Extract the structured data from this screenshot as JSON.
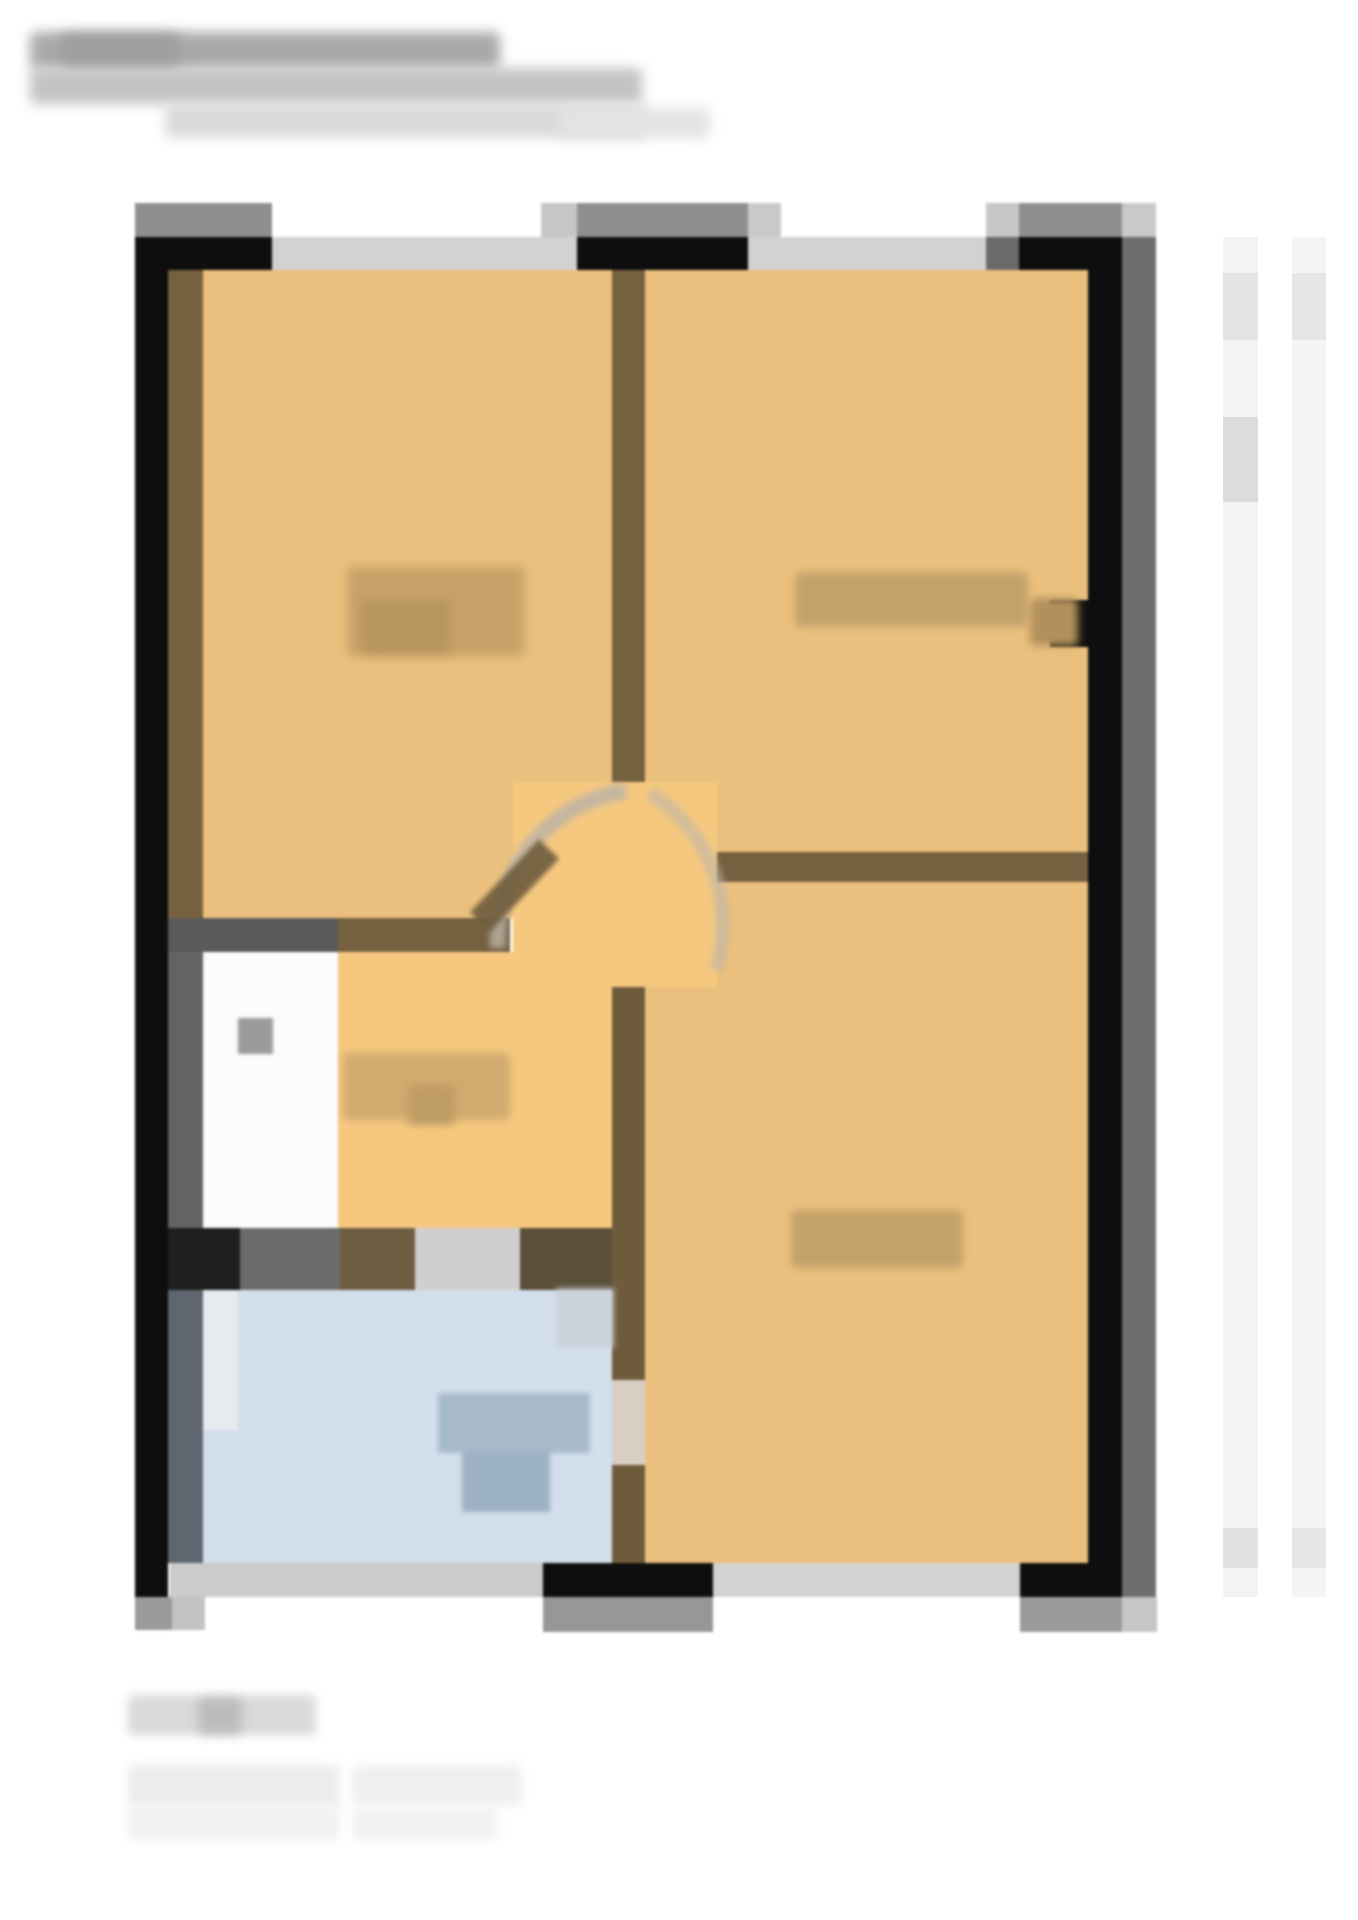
{
  "meta": {
    "canvas_w": 1358,
    "canvas_h": 1920,
    "background": "#ffffff",
    "description": "Heavily blurred / pixelated real-estate floor-plan screenshot; all text illegible"
  },
  "palette": {
    "wall_black": "#0e0e0e",
    "wall_brown": "#75613f",
    "wall_gray": "#5a5a5a",
    "window_gray": "#d2d2d2",
    "cap_gray": "#8f8f8f",
    "room_orange": "#ebc07e",
    "hall_orange": "#f6c87f",
    "wc_white": "#fbfbfb",
    "bath_blue": "#d3dfec",
    "label_tan": "#c3a16a",
    "right_wall_shadow": "#6e6e6e"
  },
  "title_block": [
    {
      "name": "title-blur-line-1",
      "x": 30,
      "y": 32,
      "w": 470,
      "h": 37,
      "color": "#a9a9a9",
      "blur": 6
    },
    {
      "name": "title-blur-line-1-dark",
      "x": 60,
      "y": 34,
      "w": 120,
      "h": 34,
      "color": "#9f9f9f",
      "blur": 6
    },
    {
      "name": "title-blur-line-2",
      "x": 30,
      "y": 68,
      "w": 612,
      "h": 36,
      "color": "#c3c3c3",
      "blur": 6
    },
    {
      "name": "title-blur-line-3",
      "x": 165,
      "y": 104,
      "w": 480,
      "h": 34,
      "color": "#dadada",
      "blur": 6
    },
    {
      "name": "title-blur-line-3-tail",
      "x": 560,
      "y": 108,
      "w": 150,
      "h": 30,
      "color": "#e3e3e3",
      "blur": 6
    }
  ],
  "floor_plan": {
    "blocks": [
      {
        "name": "room-top-left",
        "x": 203,
        "y": 270,
        "w": 409,
        "h": 648,
        "color": "#ebc07e"
      },
      {
        "name": "room-top-right",
        "x": 645,
        "y": 270,
        "w": 443,
        "h": 582,
        "color": "#ebc07e"
      },
      {
        "name": "room-bottom-right",
        "x": 645,
        "y": 882,
        "w": 443,
        "h": 681,
        "color": "#ebc07e"
      },
      {
        "name": "hallway-floor",
        "x": 513,
        "y": 782,
        "w": 204,
        "h": 205,
        "color": "#f6c87f"
      },
      {
        "name": "kitchen-floor",
        "x": 338,
        "y": 952,
        "w": 274,
        "h": 338,
        "color": "#f6c87f"
      },
      {
        "name": "wc-room-floor",
        "x": 203,
        "y": 952,
        "w": 135,
        "h": 276,
        "color": "#fbfbfb"
      },
      {
        "name": "bathroom-floor",
        "x": 203,
        "y": 1290,
        "w": 409,
        "h": 273,
        "color": "#d3dfec"
      },
      {
        "name": "wall-lining-left-top",
        "x": 168,
        "y": 270,
        "w": 35,
        "h": 648,
        "color": "#75613f"
      },
      {
        "name": "wall-mid-vertical-top",
        "x": 612,
        "y": 270,
        "w": 33,
        "h": 512,
        "color": "#75613f"
      },
      {
        "name": "wall-mid-vertical-bottom",
        "x": 612,
        "y": 987,
        "w": 33,
        "h": 576,
        "color": "#6e5b3c"
      },
      {
        "name": "wall-horizontal-right",
        "x": 717,
        "y": 852,
        "w": 371,
        "h": 30,
        "color": "#75613f"
      },
      {
        "name": "wall-horizontal-left-brown",
        "x": 338,
        "y": 918,
        "w": 172,
        "h": 34,
        "color": "#75613f"
      },
      {
        "name": "wall-horizontal-left-gray",
        "x": 168,
        "y": 918,
        "w": 170,
        "h": 34,
        "color": "#5a5a5a"
      },
      {
        "name": "wall-lining-wc-left",
        "x": 168,
        "y": 952,
        "w": 35,
        "h": 276,
        "color": "#636363"
      },
      {
        "name": "wall-band-kitchen-1",
        "x": 168,
        "y": 1228,
        "w": 72,
        "h": 62,
        "color": "#1f1f1f"
      },
      {
        "name": "wall-band-kitchen-2",
        "x": 240,
        "y": 1228,
        "w": 100,
        "h": 62,
        "color": "#6b6b6b"
      },
      {
        "name": "wall-band-kitchen-3",
        "x": 340,
        "y": 1228,
        "w": 75,
        "h": 62,
        "color": "#6e5c42"
      },
      {
        "name": "wall-band-kitchen-door",
        "x": 415,
        "y": 1228,
        "w": 105,
        "h": 62,
        "color": "#cfcfcf"
      },
      {
        "name": "wall-band-kitchen-5",
        "x": 520,
        "y": 1228,
        "w": 92,
        "h": 62,
        "color": "#5b4f3a"
      },
      {
        "name": "wall-lining-left-bottom",
        "x": 168,
        "y": 1290,
        "w": 35,
        "h": 273,
        "color": "#5f6670"
      },
      {
        "name": "bathroom-door-left",
        "x": 203,
        "y": 1290,
        "w": 35,
        "h": 140,
        "color": "#e7eaee"
      },
      {
        "name": "bathroom-door-gap-right",
        "x": 612,
        "y": 1380,
        "w": 33,
        "h": 85,
        "color": "#d8cfc2"
      },
      {
        "name": "wall-outer-left",
        "x": 135,
        "y": 237,
        "w": 33,
        "h": 1360,
        "color": "#0e0e0e"
      },
      {
        "name": "wall-outer-top-segment-1",
        "x": 135,
        "y": 237,
        "w": 137,
        "h": 33,
        "color": "#0e0e0e"
      },
      {
        "name": "window-top-1",
        "x": 272,
        "y": 237,
        "w": 305,
        "h": 33,
        "color": "#d2d2d2"
      },
      {
        "name": "wall-outer-top-segment-2",
        "x": 577,
        "y": 237,
        "w": 171,
        "h": 33,
        "color": "#0e0e0e"
      },
      {
        "name": "window-top-2",
        "x": 748,
        "y": 237,
        "w": 238,
        "h": 33,
        "color": "#d2d2d2"
      },
      {
        "name": "window-top-2-end",
        "x": 986,
        "y": 237,
        "w": 33,
        "h": 33,
        "color": "#6a6a6a"
      },
      {
        "name": "wall-outer-top-segment-3",
        "x": 1019,
        "y": 237,
        "w": 103,
        "h": 33,
        "color": "#0e0e0e"
      },
      {
        "name": "wall-outer-right",
        "x": 1088,
        "y": 237,
        "w": 34,
        "h": 1360,
        "color": "#0e0e0e"
      },
      {
        "name": "wall-outer-right-shadow",
        "x": 1122,
        "y": 237,
        "w": 34,
        "h": 1360,
        "color": "#6e6e6e"
      },
      {
        "name": "wall-right-notch",
        "x": 1050,
        "y": 600,
        "w": 38,
        "h": 47,
        "color": "#101010"
      },
      {
        "name": "window-bottom-1",
        "x": 170,
        "y": 1563,
        "w": 373,
        "h": 34,
        "color": "#cbcbcb"
      },
      {
        "name": "wall-outer-bottom-segment-1",
        "x": 543,
        "y": 1563,
        "w": 170,
        "h": 34,
        "color": "#0e0e0e"
      },
      {
        "name": "window-bottom-2",
        "x": 713,
        "y": 1563,
        "w": 307,
        "h": 34,
        "color": "#d2d2d2"
      },
      {
        "name": "wall-outer-bottom-segment-2",
        "x": 1020,
        "y": 1563,
        "w": 68,
        "h": 34,
        "color": "#0e0e0e"
      },
      {
        "name": "cap-top-1",
        "x": 135,
        "y": 203,
        "w": 137,
        "h": 34,
        "color": "#8f8f8f"
      },
      {
        "name": "cap-top-2a",
        "x": 541,
        "y": 203,
        "w": 36,
        "h": 34,
        "color": "#c6c6c6"
      },
      {
        "name": "cap-top-2",
        "x": 577,
        "y": 203,
        "w": 171,
        "h": 34,
        "color": "#8f8f8f"
      },
      {
        "name": "cap-top-2b",
        "x": 748,
        "y": 203,
        "w": 33,
        "h": 34,
        "color": "#c9c9c9"
      },
      {
        "name": "cap-top-3a",
        "x": 986,
        "y": 203,
        "w": 33,
        "h": 34,
        "color": "#c6c6c6"
      },
      {
        "name": "cap-top-3",
        "x": 1019,
        "y": 203,
        "w": 103,
        "h": 34,
        "color": "#8f8f8f"
      },
      {
        "name": "cap-top-3b",
        "x": 1122,
        "y": 203,
        "w": 34,
        "h": 34,
        "color": "#c9c9c9"
      },
      {
        "name": "cap-bottom-left-a",
        "x": 135,
        "y": 1597,
        "w": 37,
        "h": 33,
        "color": "#9a9a9a"
      },
      {
        "name": "cap-bottom-left-b",
        "x": 172,
        "y": 1597,
        "w": 33,
        "h": 33,
        "color": "#c2c2c2"
      },
      {
        "name": "cap-bottom-mid",
        "x": 543,
        "y": 1597,
        "w": 170,
        "h": 35,
        "color": "#979797"
      },
      {
        "name": "cap-bottom-right",
        "x": 1020,
        "y": 1597,
        "w": 102,
        "h": 35,
        "color": "#9a9a9a"
      },
      {
        "name": "cap-bottom-right-b",
        "x": 1122,
        "y": 1597,
        "w": 35,
        "h": 35,
        "color": "#c6c6c6"
      },
      {
        "name": "label-room-top-left",
        "x": 347,
        "y": 567,
        "w": 178,
        "h": 89,
        "color": "#c6a168",
        "blur": 5
      },
      {
        "name": "label-room-top-left-dark",
        "x": 362,
        "y": 600,
        "w": 88,
        "h": 54,
        "color": "#b8955f",
        "blur": 5
      },
      {
        "name": "label-room-top-right",
        "x": 795,
        "y": 572,
        "w": 233,
        "h": 55,
        "color": "#c3a16a",
        "blur": 4
      },
      {
        "name": "label-room-top-right-dark",
        "x": 1030,
        "y": 598,
        "w": 48,
        "h": 48,
        "color": "#b2905b",
        "blur": 4
      },
      {
        "name": "label-room-bottom-right",
        "x": 791,
        "y": 1210,
        "w": 172,
        "h": 58,
        "color": "#c3a16a",
        "blur": 4
      },
      {
        "name": "label-kitchen",
        "x": 343,
        "y": 1053,
        "w": 167,
        "h": 67,
        "color": "#d0aa6f",
        "blur": 4
      },
      {
        "name": "label-kitchen-dark",
        "x": 408,
        "y": 1085,
        "w": 47,
        "h": 40,
        "color": "#bf9c64",
        "blur": 4
      },
      {
        "name": "fixture-bath-upper",
        "x": 438,
        "y": 1393,
        "w": 152,
        "h": 60,
        "color": "#a7bac9",
        "blur": 2
      },
      {
        "name": "fixture-bath-lower",
        "x": 462,
        "y": 1450,
        "w": 88,
        "h": 62,
        "color": "#9cb1c3",
        "blur": 2
      },
      {
        "name": "fixture-wc",
        "x": 238,
        "y": 1018,
        "w": 35,
        "h": 36,
        "color": "#9b9b9b",
        "blur": 1
      },
      {
        "name": "door-marks-bath-top",
        "x": 556,
        "y": 1288,
        "w": 58,
        "h": 60,
        "color": "#c9ced6",
        "blur": 3,
        "opacity": 0.8
      }
    ],
    "arcs": [
      {
        "name": "door-swing-arc-left",
        "d": "M 498 948 A 150 150 0 0 1 626 791",
        "stroke": "#b9b3a7",
        "width": 16,
        "opacity": 0.8,
        "blur": 3
      },
      {
        "name": "door-swing-arc-right",
        "d": "M 650 793 A 155 155 0 0 1 716 970",
        "stroke": "#bdb6aa",
        "width": 14,
        "opacity": 0.6,
        "blur": 3
      },
      {
        "name": "door-leaf",
        "d": "M 480 922 L 549 849",
        "stroke": "#6e5c3e",
        "width": 28,
        "opacity": 0.9,
        "blur": 2
      }
    ]
  },
  "captions": [
    {
      "name": "caption-blur-line-1",
      "x": 128,
      "y": 1695,
      "w": 188,
      "h": 40,
      "color": "#d9d9d9",
      "blur": 5
    },
    {
      "name": "caption-blur-line-1-dark",
      "x": 198,
      "y": 1698,
      "w": 44,
      "h": 36,
      "color": "#bcbcbc",
      "blur": 5
    },
    {
      "name": "caption-blur-line-2a",
      "x": 128,
      "y": 1765,
      "w": 212,
      "h": 42,
      "color": "#ececec",
      "blur": 5
    },
    {
      "name": "caption-blur-line-2b",
      "x": 352,
      "y": 1765,
      "w": 170,
      "h": 40,
      "color": "#efefef",
      "blur": 5
    },
    {
      "name": "caption-blur-line-3a",
      "x": 128,
      "y": 1806,
      "w": 212,
      "h": 34,
      "color": "#f1f1f1",
      "blur": 5
    },
    {
      "name": "caption-blur-line-3b",
      "x": 352,
      "y": 1806,
      "w": 146,
      "h": 34,
      "color": "#f2f2f2",
      "blur": 5
    }
  ],
  "margin_strips": [
    {
      "name": "margin-strip-1",
      "x": 1223,
      "y": 237,
      "w": 35,
      "h": 1360,
      "color": "#f3f3f3"
    },
    {
      "name": "margin-strip-1-seg-a",
      "x": 1223,
      "y": 273,
      "w": 35,
      "h": 67,
      "color": "#e4e4e4"
    },
    {
      "name": "margin-strip-1-seg-b",
      "x": 1223,
      "y": 417,
      "w": 35,
      "h": 85,
      "color": "#dcdcdc"
    },
    {
      "name": "margin-strip-1-seg-c",
      "x": 1223,
      "y": 1528,
      "w": 35,
      "h": 40,
      "color": "#e2e2e2"
    },
    {
      "name": "margin-strip-2",
      "x": 1292,
      "y": 237,
      "w": 34,
      "h": 1360,
      "color": "#f5f5f5"
    },
    {
      "name": "margin-strip-2-seg-a",
      "x": 1292,
      "y": 273,
      "w": 34,
      "h": 67,
      "color": "#e6e6e6"
    },
    {
      "name": "margin-strip-2-seg-c",
      "x": 1292,
      "y": 1528,
      "w": 34,
      "h": 40,
      "color": "#e6e6e6"
    }
  ]
}
